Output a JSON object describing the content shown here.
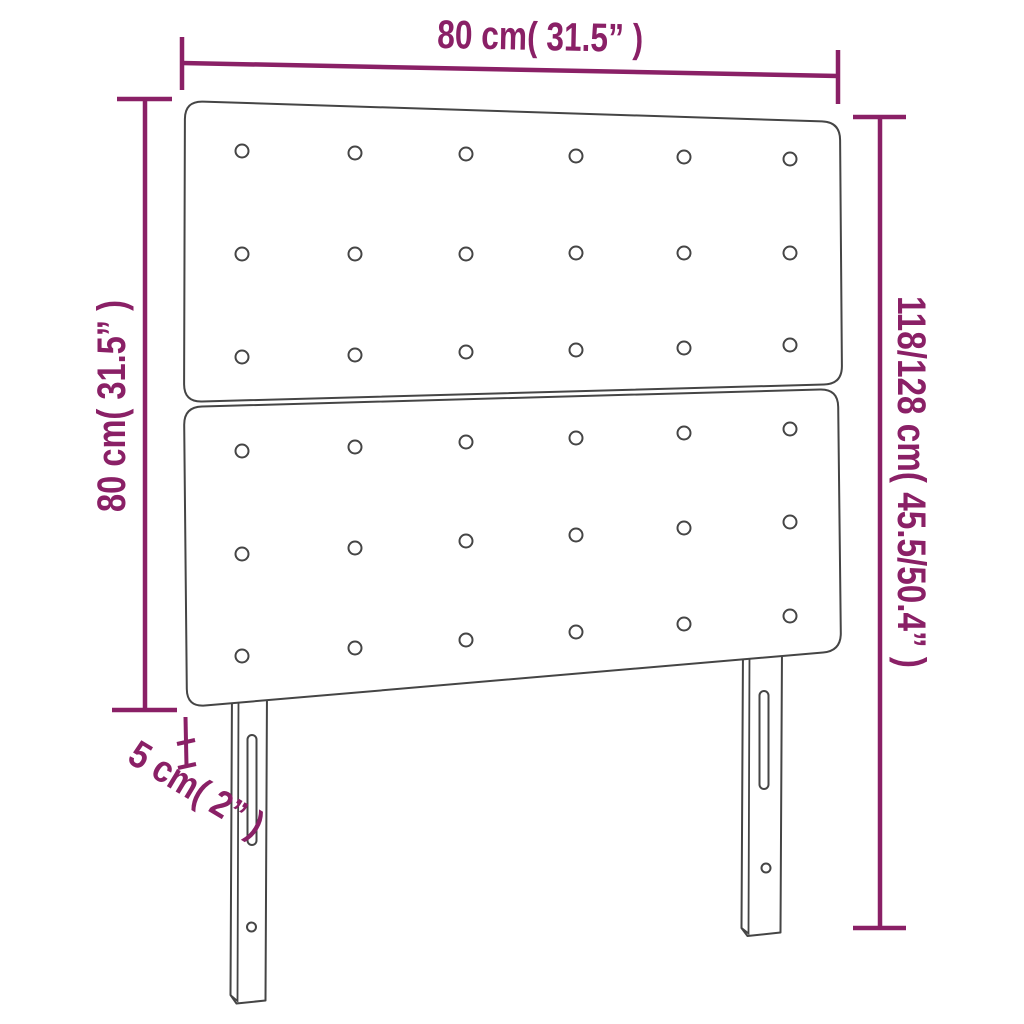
{
  "diagram_type": "product-dimension-diagram",
  "product": "tufted headboard with two stacked panels and two legs",
  "colors": {
    "background": "#ffffff",
    "dimension_lines": "#8a2066",
    "product_outline": "#454545"
  },
  "labels": {
    "width_top": "80 cm( 31.5” )",
    "height_left": "80 cm( 31.5” )",
    "total_height_right": "118/128 cm( 45.5/50.4” )",
    "depth_bottom": "5 cm( 2” )"
  },
  "structure": {
    "panels": 2,
    "button_rows_per_panel": 3,
    "button_columns_per_panel": 6,
    "legs": 2,
    "slots_per_leg": 1,
    "screw_holes_per_leg": 1
  }
}
